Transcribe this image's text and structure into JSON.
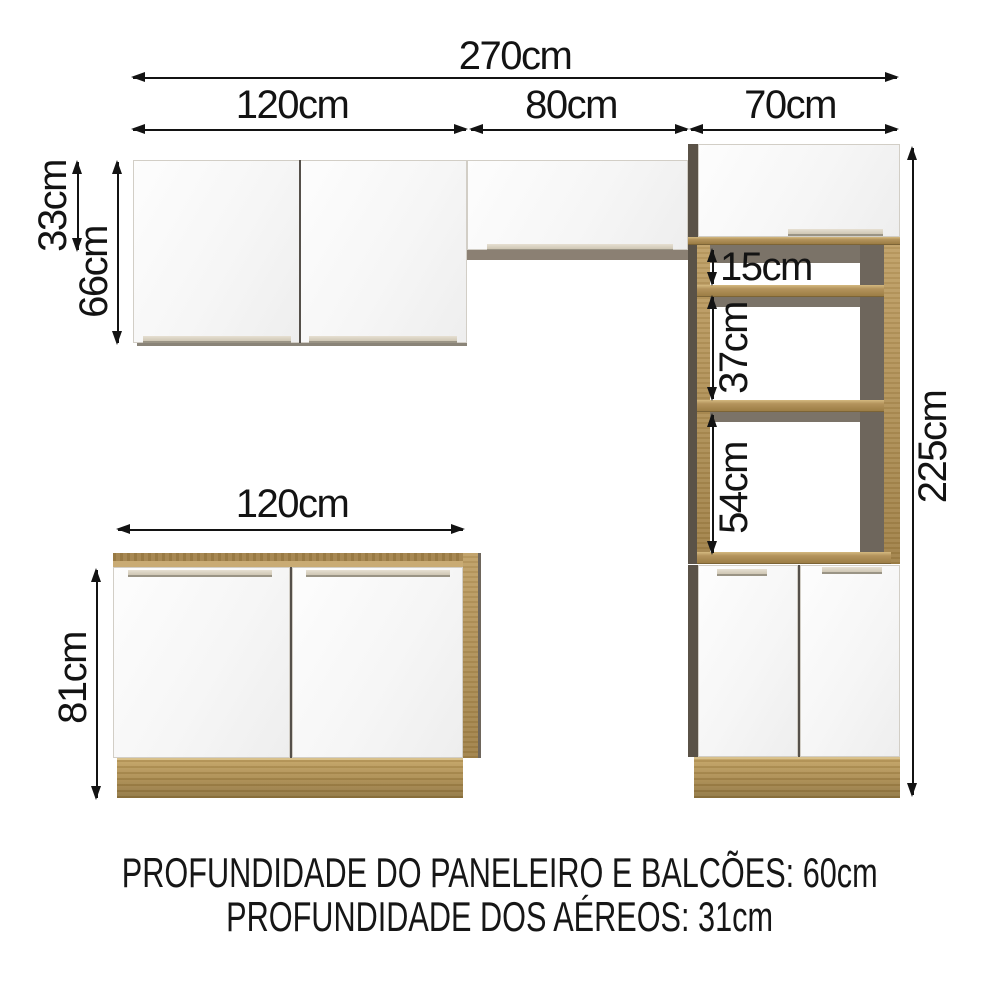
{
  "dimensions": {
    "total_width": "270cm",
    "wall_cabinet_left_width": "120cm",
    "wall_cabinet_mid_width": "80cm",
    "tall_cabinet_width": "70cm",
    "wall_cabinet_mid_height": "33cm",
    "wall_cabinet_left_height": "66cm",
    "niche_gap_top": "15cm",
    "niche_gap_middle": "37cm",
    "niche_gap_bottom": "54cm",
    "total_height": "225cm",
    "base_cabinet_width": "120cm",
    "base_cabinet_height": "81cm"
  },
  "notes": {
    "depth_line_1": "PROFUNDIDADE DO PANELEIRO E BALCÕES: 60cm",
    "depth_line_2": "PROFUNDIDADE DOS AÉREOS: 31cm"
  },
  "colors": {
    "wood": "#b1915a",
    "wood_light": "#c9ab74",
    "wood_dark": "#8f7540",
    "panel_dark_gray": "#6e665c",
    "door_white": "#fcfcfc",
    "dimension_line": "#131313"
  }
}
